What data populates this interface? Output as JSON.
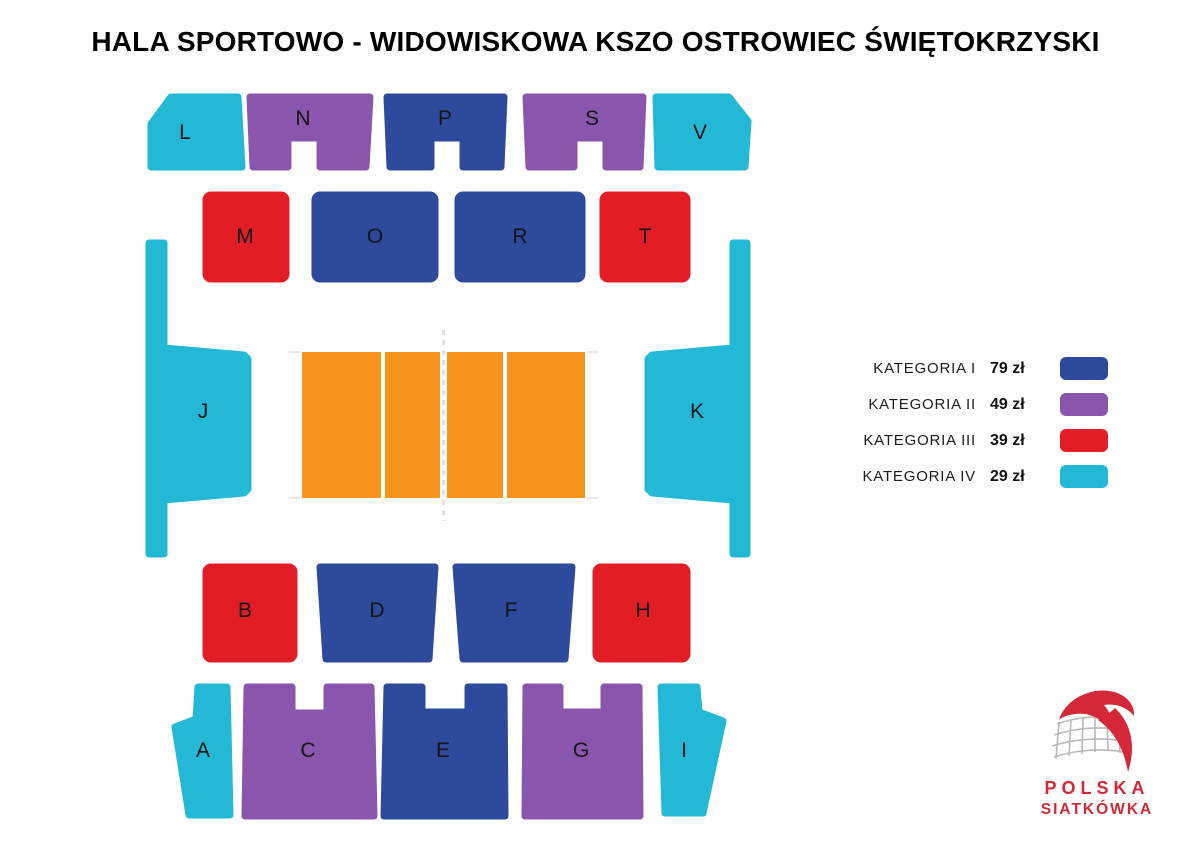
{
  "title": "HALA SPORTOWO - WIDOWISKOWA KSZO OSTROWIEC ŚWIĘTOKRZYSKI",
  "colors": {
    "category_i": "#2e4a9c",
    "category_ii": "#8a56ad",
    "category_iii": "#e21d26",
    "category_iv": "#23b8d6",
    "court": "#f7941e",
    "court_line": "#ffffff",
    "net_dash": "#e0e0e0",
    "tick_gray": "#e8e8e8",
    "logo_red": "#d42737",
    "net_gray": "#b9b9b9"
  },
  "map": {
    "sections": [
      {
        "label": "L",
        "category": "KATEGORIA IV",
        "price": "29 zł"
      },
      {
        "label": "N",
        "category": "KATEGORIA II",
        "price": "49 zł"
      },
      {
        "label": "P",
        "category": "KATEGORIA I",
        "price": "79 zł"
      },
      {
        "label": "S",
        "category": "KATEGORIA II",
        "price": "49 zł"
      },
      {
        "label": "V",
        "category": "KATEGORIA IV",
        "price": "29 zł"
      },
      {
        "label": "M",
        "category": "KATEGORIA III",
        "price": "39 zł"
      },
      {
        "label": "O",
        "category": "KATEGORIA I",
        "price": "79 zł"
      },
      {
        "label": "R",
        "category": "KATEGORIA I",
        "price": "79 zł"
      },
      {
        "label": "T",
        "category": "KATEGORIA III",
        "price": "39 zł"
      },
      {
        "label": "J",
        "category": "KATEGORIA IV",
        "price": "29 zł"
      },
      {
        "label": "K",
        "category": "KATEGORIA IV",
        "price": "29 zł"
      },
      {
        "label": "B",
        "category": "KATEGORIA III",
        "price": "39 zł"
      },
      {
        "label": "D",
        "category": "KATEGORIA I",
        "price": "79 zł"
      },
      {
        "label": "F",
        "category": "KATEGORIA I",
        "price": "79 zł"
      },
      {
        "label": "H",
        "category": "KATEGORIA III",
        "price": "39 zł"
      },
      {
        "label": "A",
        "category": "KATEGORIA IV",
        "price": "29 zł"
      },
      {
        "label": "C",
        "category": "KATEGORIA II",
        "price": "49 zł"
      },
      {
        "label": "E",
        "category": "KATEGORIA I",
        "price": "79 zł"
      },
      {
        "label": "G",
        "category": "KATEGORIA II",
        "price": "49 zł"
      },
      {
        "label": "I",
        "category": "KATEGORIA IV",
        "price": "29 zł"
      }
    ]
  },
  "legend": {
    "items": [
      {
        "label": "KATEGORIA I",
        "price": "79 zł",
        "color": "#2e4a9c"
      },
      {
        "label": "KATEGORIA II",
        "price": "49 zł",
        "color": "#8a56ad"
      },
      {
        "label": "KATEGORIA III",
        "price": "39 zł",
        "color": "#e21d26"
      },
      {
        "label": "KATEGORIA IV",
        "price": "29 zł",
        "color": "#23b8d6"
      }
    ]
  },
  "logo": {
    "line1": "POLSKA",
    "line2": "SIATKÓWKA"
  }
}
